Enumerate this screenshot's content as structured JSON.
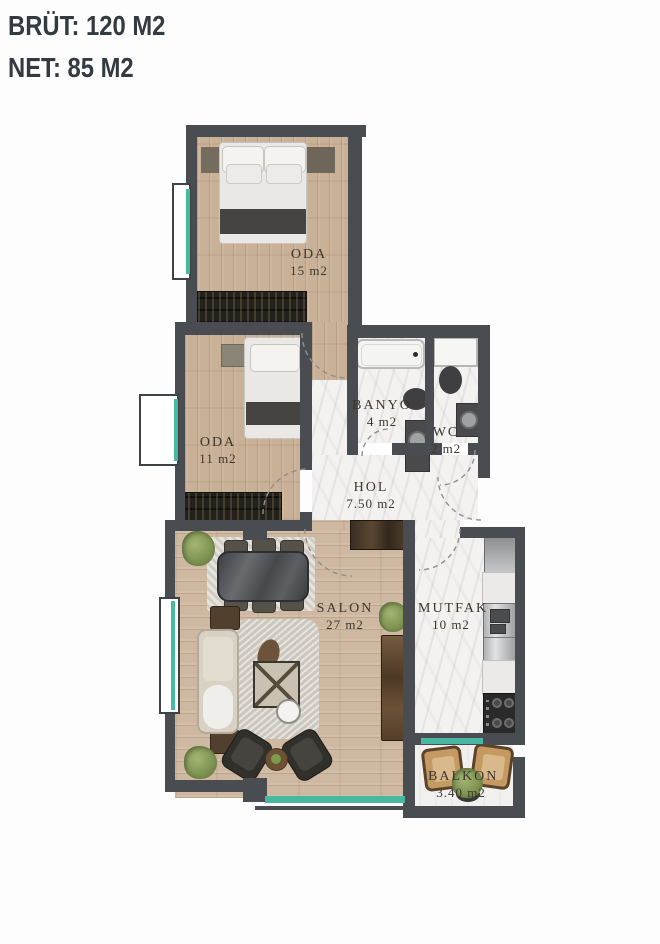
{
  "header": {
    "brut": "BRÜT: 120 M2",
    "net": "NET: 85 M2"
  },
  "rooms": {
    "oda15": {
      "name": "ODA",
      "area": "15 m2"
    },
    "oda11": {
      "name": "ODA",
      "area": "11 m2"
    },
    "banyo": {
      "name": "BANYO",
      "area": "4 m2"
    },
    "wc": {
      "name": "WC",
      "area": "2 m2"
    },
    "hol": {
      "name": "HOL",
      "area": "7.50 m2"
    },
    "salon": {
      "name": "SALON",
      "area": "27 m2"
    },
    "mutfak": {
      "name": "MUTFAK",
      "area": "10 m2"
    },
    "balkon": {
      "name": "BALKON",
      "area": "3.40 m2"
    }
  },
  "colors": {
    "wall": "#494c51",
    "wood_floor": "#c9b197",
    "marble_floor": "#f3f2f0",
    "window_glass": "#49b8a0",
    "header_text": "#343a41",
    "label_text": "#3c372e",
    "wardrobe": "#23211c",
    "plant": "#7c9150"
  }
}
